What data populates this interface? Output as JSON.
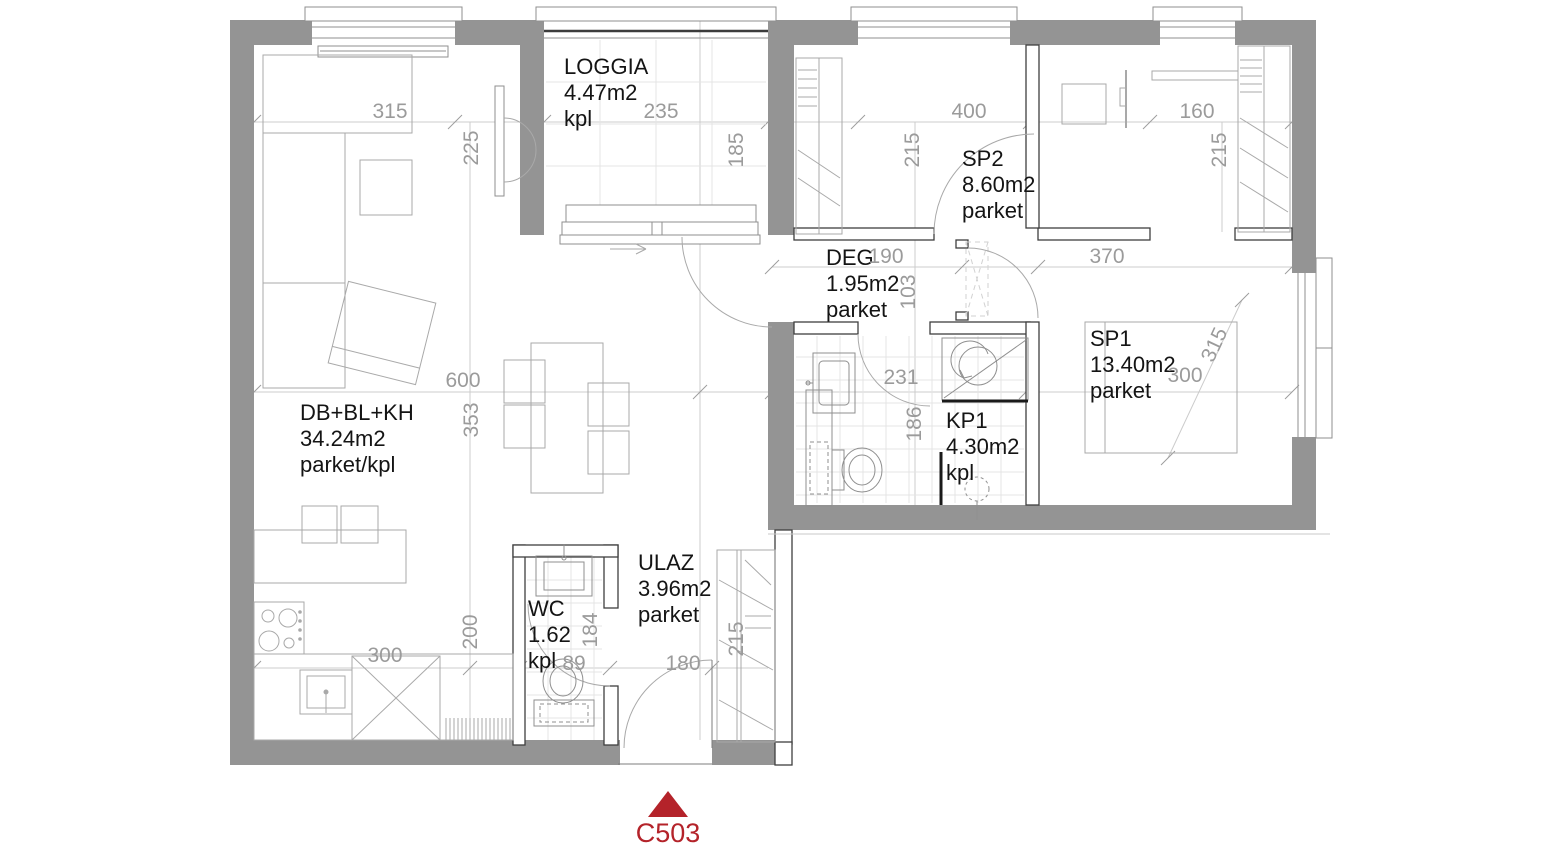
{
  "plan": {
    "unit": "C503",
    "colors": {
      "wall_gray": "#949494",
      "partition_outline": "#3f3f3f",
      "furniture_line": "#a9a9a9",
      "tile_line": "#e4e4e4",
      "dim_line": "#c9c9c9",
      "dim_text": "#9b9b9b",
      "room_text": "#141414",
      "accent_red": "#b4232a"
    },
    "rooms": {
      "living": {
        "name": "DB+BL+KH",
        "area": "34.24m2",
        "floor": "parket/kpl"
      },
      "loggia": {
        "name": "LOGGIA",
        "area": "4.47m2",
        "floor": "kpl"
      },
      "sp2": {
        "name": "SP2",
        "area": "8.60m2",
        "floor": "parket"
      },
      "deg": {
        "name": "DEG",
        "area": "1.95m2",
        "floor": "parket"
      },
      "sp1": {
        "name": "SP1",
        "area": "13.40m2",
        "floor": "parket"
      },
      "kp1": {
        "name": "KP1",
        "area": "4.30m2",
        "floor": "kpl"
      },
      "wc": {
        "name": "WC",
        "area": "1.62",
        "floor": "kpl"
      },
      "ulaz": {
        "name": "ULAZ",
        "area": "3.96m2",
        "floor": "parket"
      }
    },
    "dims": {
      "living_top_width": "315",
      "living_top_depth": "225",
      "loggia_width": "235",
      "loggia_depth": "185",
      "sp2_width": "400",
      "sp2_depth": "215",
      "closet_width": "160",
      "closet_depth": "215",
      "deg_width": "190",
      "deg_depth": "103",
      "sp1_top_width": "370",
      "sp1_diag": "315",
      "sp1_width": "300",
      "kp1_width": "231",
      "kp1_depth": "186",
      "living_mid_width": "600",
      "living_mid_depth": "353",
      "kitchen_width": "300",
      "kitchen_depth": "200",
      "wc_depth": "184",
      "wc_width": "89",
      "ulaz_width": "180",
      "ulaz_depth": "215"
    }
  }
}
